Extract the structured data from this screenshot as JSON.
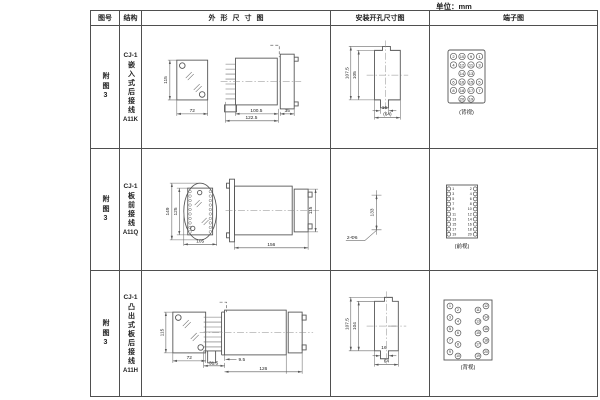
{
  "unit_label": "单位：mm",
  "table": {
    "headers": {
      "fig_no": "图号",
      "structure": "结构",
      "outline": "外形尺寸图",
      "install": "安装开孔尺寸图",
      "terminal": "端子图"
    },
    "rows": [
      {
        "fig_no": "附图3",
        "model": "CJ-1",
        "structure_name": "嵌入式后接线",
        "code": "A11K",
        "outline_dims": {
          "front_height": "115",
          "front_width": "72",
          "body_length": "100.5",
          "total_length": "122.5",
          "flange_depth": "35"
        },
        "install_dims": {
          "outer_height": "107.5",
          "inner_height": "105",
          "slot_width": "16",
          "panel_width": "(64)"
        },
        "terminal": {
          "caption": "(背视)",
          "grid": [
            [
              "2",
              "10",
              "9",
              "1"
            ],
            [
              "4",
              "12",
              "11",
              "3"
            ],
            [
              "",
              "14",
              "13",
              ""
            ],
            [
              "6",
              "16",
              "15",
              "5"
            ],
            [
              "8",
              "18",
              "17",
              "7"
            ],
            [
              "",
              "20",
              "19",
              ""
            ]
          ]
        }
      },
      {
        "fig_no": "附图3",
        "model": "CJ-1",
        "structure_name": "板前接线",
        "code": "A11Q",
        "outline_dims": {
          "front_outer_height": "149",
          "front_inner_height": "125",
          "front_width": "105",
          "side_length": "156",
          "side_height": "115"
        },
        "install_dims": {
          "hole_spacing": "133",
          "hole_spec": "2-Φ6"
        },
        "terminal": {
          "caption": "(前视)",
          "left": [
            "1",
            "3",
            "5",
            "7",
            "9",
            "11",
            "13",
            "15",
            "17",
            "19"
          ],
          "right": [
            "2",
            "4",
            "6",
            "8",
            "10",
            "12",
            "14",
            "16",
            "18",
            "20"
          ]
        }
      },
      {
        "fig_no": "附图3",
        "model": "CJ-1",
        "structure_name": "凸出式板后接线",
        "code": "A11H",
        "outline_dims": {
          "front_height": "115",
          "front_width": "72",
          "stud_width": "31.5",
          "stud_offset": "9.5",
          "body_length": "126"
        },
        "install_dims": {
          "outer_height": "107.5",
          "inner_height": "104",
          "slot_width": "16",
          "panel_width": "64"
        },
        "terminal": {
          "caption": "(背视)",
          "left_outer": [
            "1",
            "3",
            "5",
            "7",
            "9"
          ],
          "left_inner": [
            "2",
            "4",
            "6",
            "8",
            "10"
          ],
          "right_inner": [
            "11",
            "13",
            "15",
            "17",
            "19"
          ],
          "right_outer": [
            "12",
            "14",
            "16",
            "18",
            "20"
          ]
        }
      }
    ]
  }
}
